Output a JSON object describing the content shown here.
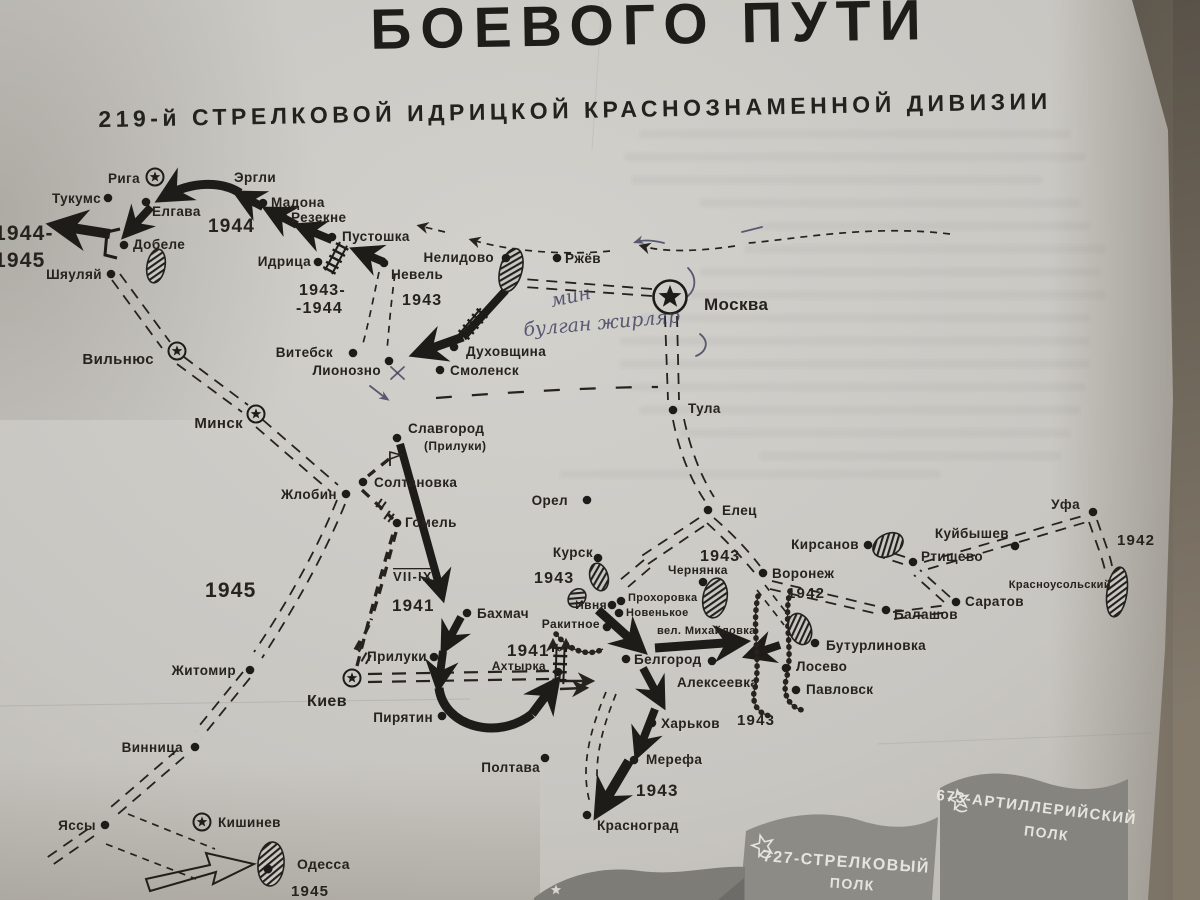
{
  "title": {
    "main": "БОЕВОГО ПУТИ",
    "sub": "219-й СТРЕЛКОВОЙ ИДРИЦКОЙ КРАСНОЗНАМЕННОЙ ДИВИЗИИ"
  },
  "colors": {
    "paper": "#c9c7c2",
    "ink": "#26231f",
    "table": "#6a6256",
    "flag_gray": "#8b8984",
    "pen_ink": "#3b3b5c"
  },
  "map": {
    "cities": [
      {
        "n": "Рига",
        "m": "star",
        "x": 155,
        "y": 177,
        "lx": 140,
        "ly": 183,
        "a": "end"
      },
      {
        "n": "Тукумс",
        "m": "dot",
        "x": 108,
        "y": 198,
        "lx": 101,
        "ly": 203,
        "a": "end"
      },
      {
        "n": "Эргли",
        "m": "dot",
        "x": 226,
        "y": 187,
        "lx": 234,
        "ly": 182,
        "a": "start"
      },
      {
        "n": "Мадона",
        "m": "dot",
        "x": 263,
        "y": 203,
        "lx": 271,
        "ly": 207,
        "a": "start"
      },
      {
        "n": "Резекне",
        "m": "dot",
        "x": 284,
        "y": 218,
        "lx": 291,
        "ly": 222,
        "a": "start"
      },
      {
        "n": "Пустошка",
        "m": "dot",
        "x": 332,
        "y": 237,
        "lx": 342,
        "ly": 241,
        "a": "start"
      },
      {
        "n": "Идрица",
        "m": "dot",
        "x": 318,
        "y": 262,
        "lx": 311,
        "ly": 266,
        "a": "end"
      },
      {
        "n": "Невель",
        "m": "dot",
        "x": 384,
        "y": 263,
        "lx": 391,
        "ly": 279,
        "a": "start"
      },
      {
        "n": "Нелидово",
        "m": "dot",
        "x": 506,
        "y": 258,
        "lx": 494,
        "ly": 262,
        "a": "end"
      },
      {
        "n": "Ржёв",
        "m": "dot",
        "x": 557,
        "y": 258,
        "lx": 565,
        "ly": 263,
        "a": "start"
      },
      {
        "n": "Москва",
        "m": "star-big",
        "x": 670,
        "y": 297,
        "lx": 704,
        "ly": 310,
        "a": "start",
        "s": 17
      },
      {
        "n": "Тула",
        "m": "dot",
        "x": 673,
        "y": 410,
        "lx": 688,
        "ly": 413,
        "a": "start"
      },
      {
        "n": "Витебск",
        "m": "dot",
        "x": 353,
        "y": 353,
        "lx": 333,
        "ly": 357,
        "a": "end"
      },
      {
        "n": "Лионозно",
        "m": "dot",
        "x": 389,
        "y": 361,
        "lx": 381,
        "ly": 375,
        "a": "end"
      },
      {
        "n": "Смоленск",
        "m": "dot",
        "x": 440,
        "y": 370,
        "lx": 450,
        "ly": 375,
        "a": "start"
      },
      {
        "n": "Духовщина",
        "m": "dot",
        "x": 454,
        "y": 347,
        "lx": 466,
        "ly": 356,
        "a": "start"
      },
      {
        "n": "Вильнюс",
        "m": "star",
        "x": 177,
        "y": 351,
        "lx": 154,
        "ly": 364,
        "a": "end",
        "s": 15
      },
      {
        "n": "Минск",
        "m": "star",
        "x": 256,
        "y": 414,
        "lx": 243,
        "ly": 428,
        "a": "end",
        "s": 15
      },
      {
        "n": "Славгород",
        "m": "dot",
        "x": 397,
        "y": 438,
        "lx": 408,
        "ly": 433,
        "a": "start"
      },
      {
        "n": "(Прилуки)",
        "m": "none",
        "x": 0,
        "y": 0,
        "lx": 424,
        "ly": 450,
        "a": "start",
        "s": 12
      },
      {
        "n": "Солтановка",
        "m": "dot",
        "x": 363,
        "y": 482,
        "lx": 374,
        "ly": 487,
        "a": "start"
      },
      {
        "n": "Гомель",
        "m": "dot",
        "x": 397,
        "y": 523,
        "lx": 405,
        "ly": 527,
        "a": "start"
      },
      {
        "n": "Жлобин",
        "m": "dot",
        "x": 346,
        "y": 494,
        "lx": 337,
        "ly": 499,
        "a": "end"
      },
      {
        "n": "Орел",
        "m": "dot",
        "x": 587,
        "y": 500,
        "lx": 568,
        "ly": 505,
        "a": "end"
      },
      {
        "n": "Елец",
        "m": "dot",
        "x": 708,
        "y": 510,
        "lx": 722,
        "ly": 515,
        "a": "start"
      },
      {
        "n": "Воронеж",
        "m": "dot",
        "x": 763,
        "y": 573,
        "lx": 772,
        "ly": 578,
        "a": "start"
      },
      {
        "n": "Кирсанов",
        "m": "dot",
        "x": 868,
        "y": 545,
        "lx": 859,
        "ly": 549,
        "a": "end"
      },
      {
        "n": "Ртищево",
        "m": "dot",
        "x": 913,
        "y": 562,
        "lx": 921,
        "ly": 561,
        "a": "start"
      },
      {
        "n": "Куйбышев",
        "m": "dot",
        "x": 1015,
        "y": 546,
        "lx": 1009,
        "ly": 538,
        "a": "end"
      },
      {
        "n": "Саратов",
        "m": "dot",
        "x": 956,
        "y": 602,
        "lx": 965,
        "ly": 606,
        "a": "start"
      },
      {
        "n": "Балашов",
        "m": "dot",
        "x": 886,
        "y": 610,
        "lx": 894,
        "ly": 619,
        "a": "start"
      },
      {
        "n": "Уфа",
        "m": "dot",
        "x": 1093,
        "y": 512,
        "lx": 1080,
        "ly": 509,
        "a": "end"
      },
      {
        "n": "Красноусольский",
        "m": "none",
        "x": 0,
        "y": 0,
        "lx": 1111,
        "ly": 588,
        "a": "end",
        "s": 11
      },
      {
        "n": "Бутурлиновка",
        "m": "dot",
        "x": 815,
        "y": 643,
        "lx": 826,
        "ly": 650,
        "a": "start"
      },
      {
        "n": "Лосево",
        "m": "dot",
        "x": 786,
        "y": 668,
        "lx": 796,
        "ly": 671,
        "a": "start"
      },
      {
        "n": "Павловск",
        "m": "dot",
        "x": 796,
        "y": 690,
        "lx": 806,
        "ly": 694,
        "a": "start"
      },
      {
        "n": "Курск",
        "m": "dot",
        "x": 598,
        "y": 558,
        "lx": 593,
        "ly": 557,
        "a": "end"
      },
      {
        "n": "Ивня",
        "m": "dot",
        "x": 612,
        "y": 605,
        "lx": 607,
        "ly": 609,
        "a": "end",
        "s": 12
      },
      {
        "n": "Прохоровка",
        "m": "dot",
        "x": 621,
        "y": 601,
        "lx": 628,
        "ly": 601,
        "a": "start",
        "s": 11
      },
      {
        "n": "Новенькое",
        "m": "dot",
        "x": 619,
        "y": 613,
        "lx": 626,
        "ly": 616,
        "a": "start",
        "s": 11
      },
      {
        "n": "вел. Михайловка",
        "m": "none",
        "x": 0,
        "y": 0,
        "lx": 657,
        "ly": 634,
        "a": "start",
        "s": 11
      },
      {
        "n": "Чернянка",
        "m": "dot",
        "x": 703,
        "y": 582,
        "lx": 668,
        "ly": 574,
        "a": "start",
        "s": 12
      },
      {
        "n": "Ракитное",
        "m": "dot",
        "x": 607,
        "y": 627,
        "lx": 600,
        "ly": 628,
        "a": "end",
        "s": 12
      },
      {
        "n": "Белгород",
        "m": "dot",
        "x": 626,
        "y": 659,
        "lx": 634,
        "ly": 664,
        "a": "start"
      },
      {
        "n": "Алексеевка",
        "m": "dot",
        "x": 712,
        "y": 661,
        "lx": 677,
        "ly": 687,
        "a": "start"
      },
      {
        "n": "Харьков",
        "m": "dot",
        "x": 652,
        "y": 723,
        "lx": 661,
        "ly": 728,
        "a": "start"
      },
      {
        "n": "Мерефа",
        "m": "dot",
        "x": 634,
        "y": 760,
        "lx": 646,
        "ly": 764,
        "a": "start"
      },
      {
        "n": "Красноград",
        "m": "dot",
        "x": 587,
        "y": 815,
        "lx": 597,
        "ly": 830,
        "a": "start"
      },
      {
        "n": "Бахмач",
        "m": "dot",
        "x": 467,
        "y": 613,
        "lx": 477,
        "ly": 618,
        "a": "start"
      },
      {
        "n": "Прилуки",
        "m": "dot",
        "x": 434,
        "y": 657,
        "lx": 427,
        "ly": 661,
        "a": "end"
      },
      {
        "n": "Ахтырка",
        "m": "dot",
        "x": 558,
        "y": 672,
        "lx": 546,
        "ly": 670,
        "a": "end",
        "s": 12
      },
      {
        "n": "Пирятин",
        "m": "dot",
        "x": 442,
        "y": 716,
        "lx": 433,
        "ly": 722,
        "a": "end"
      },
      {
        "n": "Киев",
        "m": "star",
        "x": 352,
        "y": 678,
        "lx": 327,
        "ly": 706,
        "a": "middle",
        "s": 16
      },
      {
        "n": "Житомир",
        "m": "dot",
        "x": 250,
        "y": 670,
        "lx": 236,
        "ly": 675,
        "a": "end"
      },
      {
        "n": "Винница",
        "m": "dot",
        "x": 195,
        "y": 747,
        "lx": 183,
        "ly": 752,
        "a": "end"
      },
      {
        "n": "Полтава",
        "m": "dot",
        "x": 545,
        "y": 758,
        "lx": 540,
        "ly": 772,
        "a": "end"
      },
      {
        "n": "Яссы",
        "m": "dot",
        "x": 105,
        "y": 825,
        "lx": 96,
        "ly": 830,
        "a": "end"
      },
      {
        "n": "Кишинев",
        "m": "star",
        "x": 202,
        "y": 822,
        "lx": 218,
        "ly": 827,
        "a": "start"
      },
      {
        "n": "Одесса",
        "m": "none",
        "x": 0,
        "y": 0,
        "lx": 297,
        "ly": 869,
        "a": "start",
        "s": 14
      },
      {
        "n": "Шяуляй",
        "m": "dot",
        "x": 111,
        "y": 274,
        "lx": 102,
        "ly": 279,
        "a": "end"
      },
      {
        "n": "Добеле",
        "m": "dot",
        "x": 124,
        "y": 245,
        "lx": 133,
        "ly": 249,
        "a": "start"
      },
      {
        "n": "Елгава",
        "m": "dot",
        "x": 146,
        "y": 202,
        "lx": 152,
        "ly": 216,
        "a": "start"
      }
    ],
    "dates": [
      {
        "t": "1944-",
        "x": -6,
        "y": 240,
        "s": 21
      },
      {
        "t": "1945",
        "x": -6,
        "y": 267,
        "s": 21
      },
      {
        "t": "1944",
        "x": 208,
        "y": 232,
        "s": 19
      },
      {
        "t": "1943-",
        "x": 299,
        "y": 295,
        "s": 16
      },
      {
        "t": "-1944",
        "x": 296,
        "y": 313,
        "s": 16
      },
      {
        "t": "1943",
        "x": 402,
        "y": 305,
        "s": 16
      },
      {
        "t": "1945",
        "x": 205,
        "y": 597,
        "s": 21
      },
      {
        "t": "VII-IX",
        "x": 393,
        "y": 581,
        "s": 13,
        "over": true
      },
      {
        "t": "1941",
        "x": 392,
        "y": 611,
        "s": 17
      },
      {
        "t": "1941",
        "x": 507,
        "y": 656,
        "s": 17
      },
      {
        "t": "1943",
        "x": 534,
        "y": 583,
        "s": 16
      },
      {
        "t": "1943",
        "x": 700,
        "y": 561,
        "s": 16
      },
      {
        "t": "1943",
        "x": 737,
        "y": 725,
        "s": 15
      },
      {
        "t": "1943",
        "x": 636,
        "y": 796,
        "s": 17
      },
      {
        "t": "1942",
        "x": 787,
        "y": 598,
        "s": 15
      },
      {
        "t": "1942",
        "x": 1117,
        "y": 545,
        "s": 15
      },
      {
        "t": "1945",
        "x": 291,
        "y": 896,
        "s": 15
      }
    ],
    "notes": [
      {
        "t": "мин",
        "x": 552,
        "y": 307,
        "r": -12
      },
      {
        "t": "булган жирляр",
        "x": 524,
        "y": 336,
        "r": -5
      }
    ],
    "flags": [
      {
        "label": "727-СТРЕЛКОВЫЙ",
        "unit": "ПОЛК"
      },
      {
        "label": "673-АРТИЛЛЕРИЙСКИЙ",
        "unit": "ПОЛК"
      }
    ]
  }
}
